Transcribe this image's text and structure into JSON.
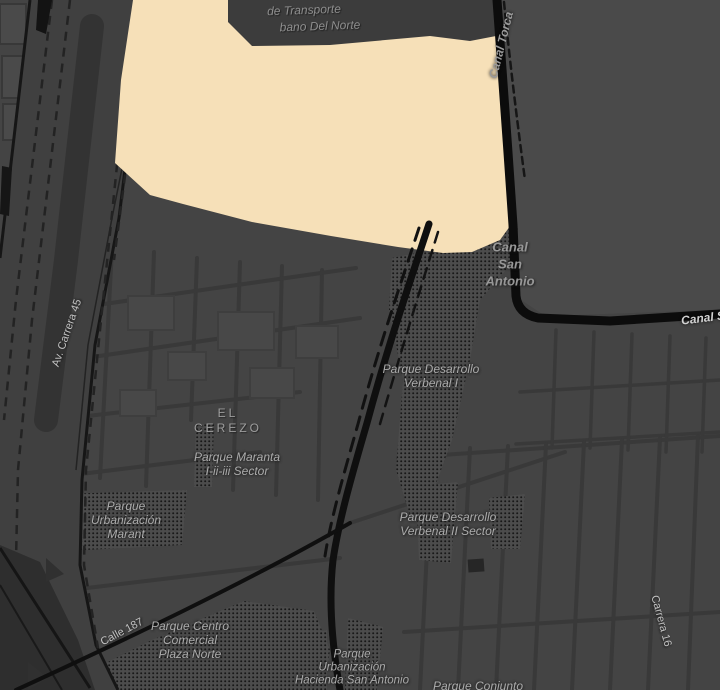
{
  "map": {
    "colors": {
      "background": "#444444",
      "street": "#393939",
      "highway_fill": "#404040",
      "highway_edge": "#161616",
      "major_road": "#0f0f0f",
      "canal": "#0c0c0c",
      "terminal_zone": "#f6e0b8",
      "terminal_building": "#3c3c3c",
      "park_base": "#4c4c4c",
      "park_dot": "#181818",
      "park_label": "#ababab",
      "street_label": "#c2c2c2",
      "area_label": "#9d9d9d"
    },
    "labels": {
      "terminal": {
        "lines": [
          "de Transporte",
          "bano Del Norte"
        ]
      },
      "canal_torca": {
        "lines": [
          "Canal Torca"
        ]
      },
      "canal_san_antonio": {
        "lines": [
          "Canal",
          "San",
          "Antonio"
        ]
      },
      "canal_san_east": {
        "lines": [
          "Canal S"
        ]
      },
      "av_carrera_45": {
        "lines": [
          "Av. Carrera 45"
        ]
      },
      "parque_desarrollo_verbenal_1": {
        "lines": [
          "Parque Desarrollo",
          "Verbenal I"
        ]
      },
      "el_cerezo": {
        "lines": [
          "EL",
          "CEREZO"
        ]
      },
      "parque_maranta": {
        "lines": [
          "Parque Maranta",
          "I-ii-iii Sector"
        ]
      },
      "parque_urbanizacion_marant": {
        "lines": [
          "Parque",
          "Urbanización",
          "Marant"
        ]
      },
      "parque_desarrollo_verbenal_2": {
        "lines": [
          "Parque Desarrollo",
          "Verbenal II Sector"
        ]
      },
      "calle_187": {
        "lines": [
          "Calle 187"
        ]
      },
      "parque_centro_comercial": {
        "lines": [
          "Parque Centro",
          "Comercial",
          "Plaza Norte"
        ]
      },
      "carrera_16": {
        "lines": [
          "Carrera 16"
        ]
      },
      "parque_urb_hacienda": {
        "lines": [
          "Parque",
          "Urbanización",
          "Hacienda San Antonio"
        ]
      },
      "parque_conjunto": {
        "lines": [
          "Parque Conjunto"
        ]
      }
    }
  }
}
